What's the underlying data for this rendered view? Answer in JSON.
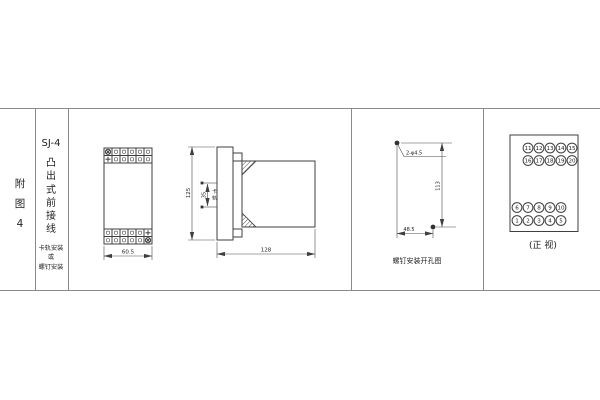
{
  "sheet": {
    "figure_chars": [
      "附",
      "图",
      "4"
    ],
    "model": "SJ-4",
    "type_chars": [
      "凸",
      "出",
      "式",
      "前",
      "接",
      "线"
    ],
    "mount_lines": [
      "卡轨安装",
      "或",
      "螺钉安装"
    ]
  },
  "outline_view": {
    "width_dim": "60.5"
  },
  "side_view": {
    "height_dim": "125",
    "rail_dim": "35",
    "rail_label_chars": [
      "卡",
      "轨"
    ],
    "depth_dim": "128"
  },
  "drill_view": {
    "hole_label": "2-φ4.5",
    "height_dim": "113",
    "width_dim": "48.5",
    "caption": "螺钉安装开孔图"
  },
  "front_view": {
    "caption": "(正 视)",
    "rows": [
      [
        "11",
        "12",
        "13",
        "14",
        "15"
      ],
      [
        "16",
        "17",
        "18",
        "19",
        "20"
      ],
      [
        "6",
        "7",
        "8",
        "9",
        "10"
      ],
      [
        "1",
        "2",
        "3",
        "4",
        "5"
      ]
    ]
  },
  "colors": {
    "line": "#3f3f3f",
    "grid": "#8a8a8a",
    "text": "#222222"
  }
}
